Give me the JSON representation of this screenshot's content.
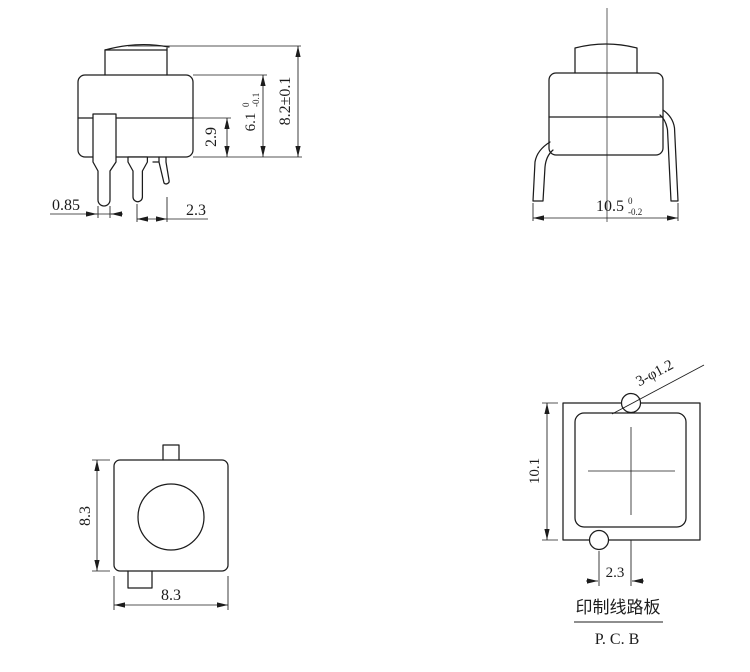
{
  "canvas": {
    "width": 750,
    "height": 672,
    "background": "#ffffff",
    "ink": "#1c1c1c"
  },
  "views": {
    "side": {
      "dims": {
        "pin_width": "0.85",
        "pin_spacing": "2.3",
        "lower_body_height": "2.9",
        "body_height": {
          "value": "6.1",
          "tol_upper": "0",
          "tol_lower": "-0.1"
        },
        "overall_height": "8.2±0.1"
      }
    },
    "front": {
      "dims": {
        "lead_span": {
          "value": "10.5",
          "tol_upper": "0",
          "tol_lower": "-0.2"
        }
      }
    },
    "bottom": {
      "dims": {
        "body_height": "8.3",
        "body_width": "8.3"
      }
    },
    "pcb": {
      "dims": {
        "pad_height": "10.1",
        "hole_offset": "2.3"
      },
      "hole_callout": "3-φ1.2",
      "caption_cn": "印制线路板",
      "caption_en": "P. C. B"
    }
  }
}
